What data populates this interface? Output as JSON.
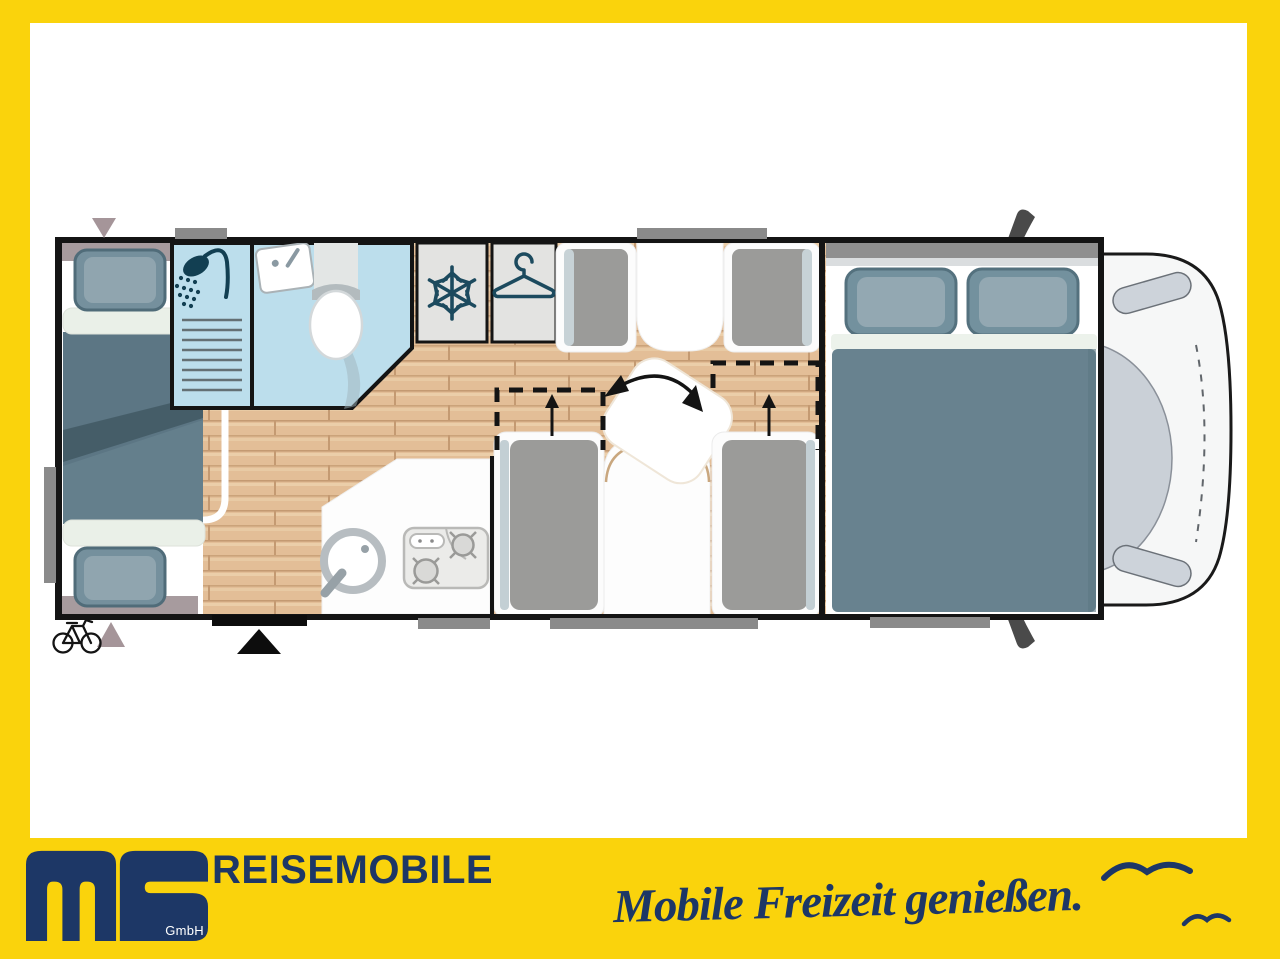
{
  "brand": {
    "logo_text": "ms",
    "logo_suffix": "GmbH",
    "title": "REISEMOBILE",
    "tagline": "Mobile Freizeit genießen."
  },
  "colors": {
    "frame_yellow": "#FAD30C",
    "brand_navy": "#1D3766",
    "bath_blue": "#BCDEEC",
    "floor_wood": "#E3BE97",
    "cabinet_gray": "#E3E3E1",
    "cushion_gray": "#9B9B99",
    "bed_slate": "#68828F",
    "pillow_slate": "#73919E",
    "icon_teal": "#1C4A5E",
    "wall_black": "#141414",
    "tab_gray": "#8A8A8A",
    "marker_mauve": "#A59599"
  },
  "floorplan": {
    "vehicle_type": "motorhome",
    "view": "top-down",
    "rooms": [
      {
        "name": "rear-bunk-beds"
      },
      {
        "name": "shower"
      },
      {
        "name": "washroom-toilet"
      },
      {
        "name": "refrigerator"
      },
      {
        "name": "wardrobe"
      },
      {
        "name": "dinette-with-rotating-table"
      },
      {
        "name": "kitchen"
      },
      {
        "name": "double-bedroom"
      },
      {
        "name": "driver-cab"
      }
    ],
    "icons": [
      "shower-icon",
      "sink-icon",
      "toilet-icon",
      "snowflake-icon",
      "hanger-icon",
      "rotation-arrow-icon",
      "up-arrow-icon",
      "bicycle-icon",
      "entry-door-marker",
      "seagull-icon"
    ]
  }
}
